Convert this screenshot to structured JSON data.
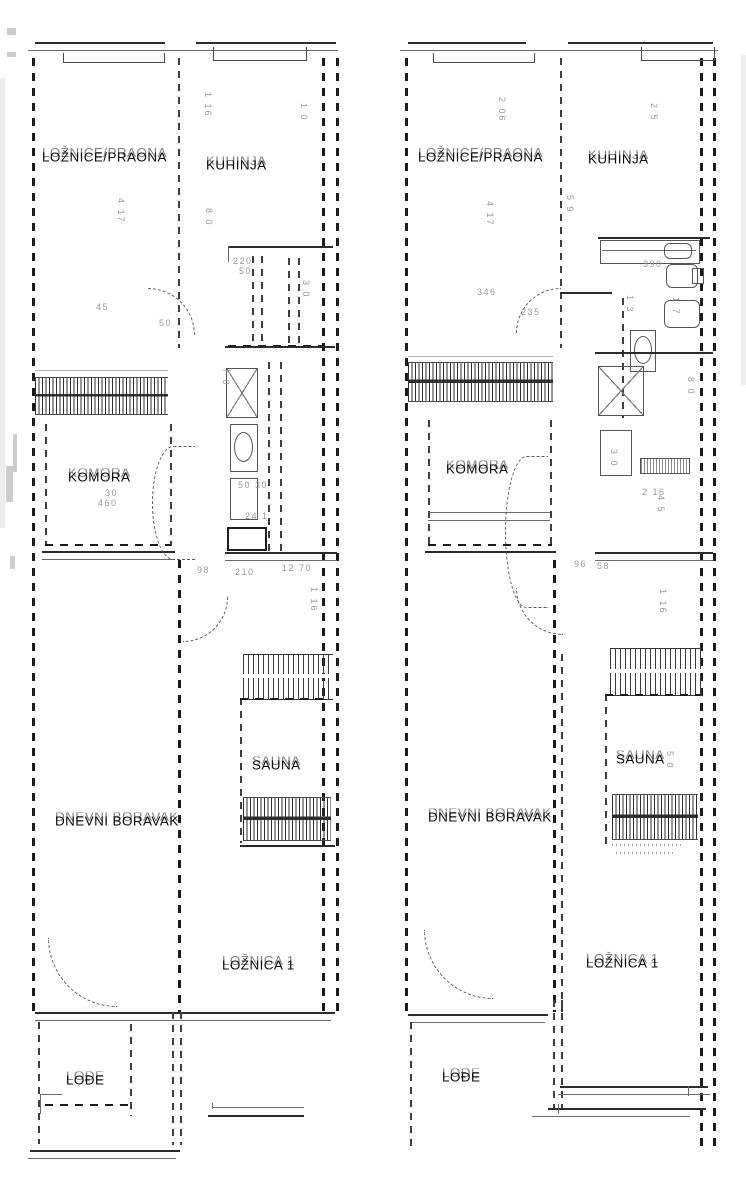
{
  "palette": {
    "ink": "#1b1b1b",
    "line_gray": "#666666",
    "dim_text": "#979797",
    "background": "#ffffff"
  },
  "plans": {
    "left": {
      "rooms": {
        "bedroom_laundry": "LOŽNICE/PRAONA",
        "kitchen": "KUHINJA",
        "pantry": "KOMORA",
        "sauna": "SAUNA",
        "living": "DNEVNI BORAVAK",
        "bedroom1": "LOŽNICA 1",
        "loggia": "LOĐE"
      },
      "dims": [
        "1 16",
        "1 0",
        "4 17",
        "8 0",
        "220",
        "50",
        "3 0",
        "45",
        "50",
        "7 0",
        "30",
        "460",
        "50 30",
        "24 1",
        "98",
        "210",
        "12 70",
        "1 16"
      ]
    },
    "right": {
      "rooms": {
        "bedroom_laundry": "LOŽNICE/PRAONA",
        "kitchen": "KUHINJA",
        "pantry": "KOMORA",
        "sauna": "SAUNA",
        "living": "DNEVNI BORAVAK",
        "bedroom1": "LOŽNICA 1",
        "loggia": "LOĐE"
      },
      "dims": [
        "2 06",
        "2 5",
        "4 17",
        "5 9",
        "390",
        "1 3",
        "346",
        "235",
        "1 7",
        "8 0",
        "3 0",
        "2 16",
        "4 5",
        "96",
        "1 16",
        "5 0",
        "58"
      ]
    }
  }
}
